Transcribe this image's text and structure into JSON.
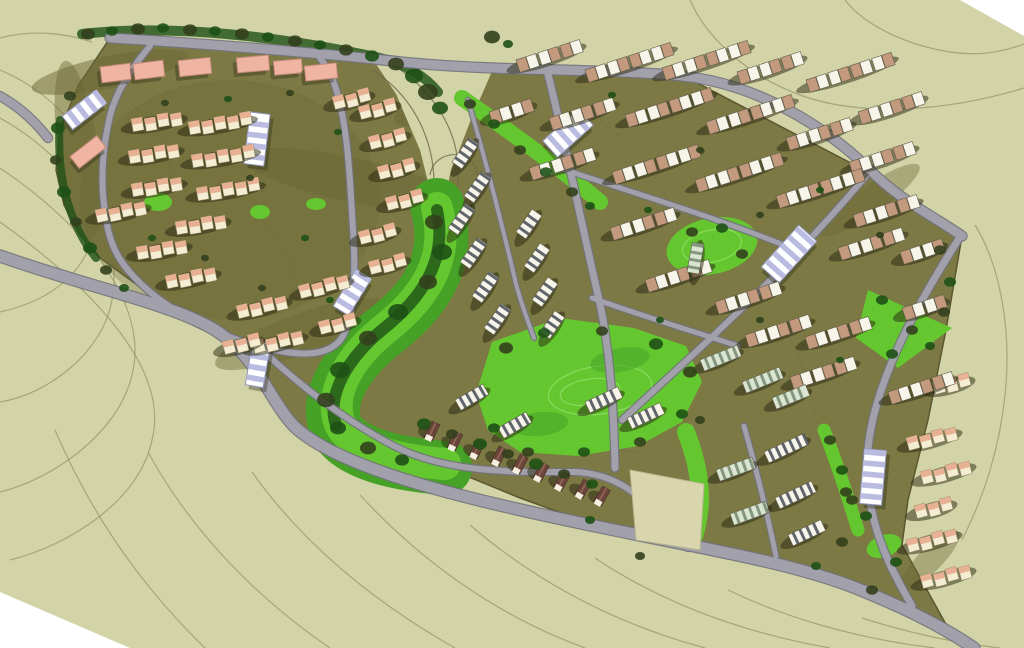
{
  "canvas": {
    "width": 1024,
    "height": 648
  },
  "palette": {
    "sage": "#d2d3a6",
    "paper": "#ffffff",
    "contour": "#97966c",
    "contour_dark": "#6b6a48",
    "site_olive": "#7c7944",
    "site_edge": "#5a5732",
    "hill_olive": "#6b6836",
    "road_fill": "#a1a0ab",
    "road_edge": "#72717c",
    "green_bright": "#64c72f",
    "green_mid": "#46a226",
    "green_dark": "#1f5c16",
    "green_ring": "#8fdd66",
    "tree_a": "#33401d",
    "tree_b": "#1e5116",
    "cream": "#f4edd3",
    "cabin_roof": "#e8b193",
    "cabin_edge": "#8a8560",
    "salmon_block": "#efb4a2",
    "salmon_edge": "#c28a79",
    "tan_roof": "#c49a7e",
    "white_roof": "#f7f4ea",
    "unit_edge": "#5f5c48",
    "stripe_dark": "#474c57",
    "mint_base": "#dbe6d2",
    "mint_stripe": "#74876e",
    "lav_stripe": "#b9bce0",
    "lav_edge": "#9096bb",
    "cottage_roof": "#6b453a",
    "cottage_ridge": "#93685a",
    "gable": "#f5f0e0",
    "parcel": "#d9d6ae",
    "parcel_edge": "#b9b690",
    "shadow": "rgba(40,40,16,0.5)",
    "shadow_soft": "rgba(40,40,16,0.35)"
  },
  "terrain": {
    "corners": [
      "0,592 130,648 0,648",
      "960,0 1024,0 1024,36"
    ]
  },
  "contours": [
    "M0,70 C60,95 105,150 98,215 C92,268 55,300 0,312",
    "M0,118 C75,160 125,235 112,300 C102,355 45,395 0,402",
    "M0,168 C85,225 150,305 132,375 C118,435 50,480 0,492",
    "M0,222 C95,290 170,370 152,440 C140,500 70,545 10,560",
    "M55,430 C85,500 130,575 205,648",
    "M148,452 C185,520 245,590 330,648",
    "M252,472 C300,540 370,600 455,648",
    "M360,495 C420,560 495,615 585,648",
    "M470,525 C540,585 620,625 705,648",
    "M595,558 C665,605 745,633 830,648",
    "M728,590 C790,620 865,640 935,648",
    "M862,618 C905,632 955,643 1000,648",
    "M690,0 C705,35 745,75 800,95 C860,117 945,112 1024,88",
    "M845,0 C862,22 900,44 950,52 C975,56 1000,53 1024,44",
    "M975,225 C1000,265 1012,330 1005,395 C1000,445 985,495 962,540",
    "M0,38 C30,30 62,32 92,42"
  ],
  "site": {
    "outline": "110,38 400,60 680,74 868,172 962,236 946,330 928,420 908,500 902,545 948,628 905,608 856,588 790,562 688,548 600,527 520,498 396,447 340,444 294,426 266,396 254,346 200,322 158,300 100,258 80,235 64,205 56,170 60,130 78,86",
    "shading": [
      [
        230,
        200,
        150,
        120,
        0,
        0.3
      ],
      [
        110,
        72,
        80,
        16,
        -12,
        0.5
      ],
      [
        78,
        150,
        20,
        90,
        -8,
        0.45
      ],
      [
        352,
        180,
        22,
        115,
        -78,
        0.5
      ],
      [
        300,
        334,
        90,
        20,
        -20,
        0.45
      ],
      [
        430,
        102,
        40,
        16,
        -30,
        0.5
      ],
      [
        870,
        200,
        60,
        14,
        -35,
        0.4
      ],
      [
        930,
        560,
        40,
        12,
        -45,
        0.4
      ]
    ],
    "wedge": "368,52 496,62 470,122 450,174 440,230 420,150 396,94",
    "wedge_contours": [
      "M372,70 C402,88 425,120 432,160 C436,185 434,205 430,222",
      "M388,62 C420,80 448,112 456,150 C460,175 458,198 452,218",
      "M398,186 C418,205 448,210 468,196 C486,183 478,158 458,155 C444,153 432,162 430,175"
    ],
    "inner_contours": [
      "M120,95 C150,115 175,150 170,190",
      "M600,120 C640,150 670,190 680,235",
      "M760,300 C790,330 810,370 815,415",
      "M520,420 C560,440 600,450 640,452",
      "M250,210 C280,235 300,270 298,305"
    ]
  },
  "greens": [
    {
      "kind": "band",
      "d": "M437,205 C452,258 428,298 386,330 C348,360 324,396 336,428 C348,452 392,464 445,468",
      "w": 54,
      "c": "green_mid"
    },
    {
      "kind": "band",
      "d": "M437,208 C450,258 426,296 386,328 C350,356 328,394 340,424 C352,448 394,460 445,464",
      "w": 32,
      "c": "green_bright"
    },
    {
      "kind": "poly",
      "pts": "492,342 560,318 634,328 686,346 702,382 682,422 638,446 578,456 520,452 488,430 476,394",
      "c": "green_bright"
    },
    {
      "kind": "ring",
      "cx": 600,
      "cy": 390,
      "rx": 52,
      "ry": 24,
      "rot": -8
    },
    {
      "kind": "ring",
      "cx": 590,
      "cy": 392,
      "rx": 30,
      "ry": 13,
      "rot": -8
    },
    {
      "kind": "ellipse",
      "cx": 712,
      "cy": 246,
      "rx": 46,
      "ry": 28,
      "rot": -12,
      "c": "green_bright"
    },
    {
      "kind": "ring",
      "cx": 712,
      "cy": 246,
      "rx": 30,
      "ry": 16,
      "rot": -12
    },
    {
      "kind": "poly",
      "pts": "868,290 952,328 898,368 856,338",
      "c": "green_bright"
    },
    {
      "kind": "band",
      "d": "M462,98 C508,130 558,166 600,202",
      "w": 16,
      "c": "green_bright"
    },
    {
      "kind": "band",
      "d": "M686,432 C700,468 706,504 692,542",
      "w": 18,
      "c": "green_bright"
    },
    {
      "kind": "band",
      "d": "M824,430 C838,466 848,498 858,530",
      "w": 13,
      "c": "green_bright"
    },
    {
      "kind": "ellipse",
      "cx": 158,
      "cy": 202,
      "rx": 14,
      "ry": 9,
      "rot": 0,
      "c": "green_bright"
    },
    {
      "kind": "ellipse",
      "cx": 260,
      "cy": 212,
      "rx": 10,
      "ry": 7,
      "rot": 0,
      "c": "green_bright"
    },
    {
      "kind": "ellipse",
      "cx": 316,
      "cy": 204,
      "rx": 10,
      "ry": 6,
      "rot": 0,
      "c": "green_bright"
    },
    {
      "kind": "ellipse",
      "cx": 884,
      "cy": 546,
      "rx": 18,
      "ry": 11,
      "rot": -20,
      "c": "green_bright"
    },
    {
      "kind": "ellipse",
      "cx": 620,
      "cy": 360,
      "rx": 30,
      "ry": 12,
      "rot": -10,
      "c": "green_mid"
    },
    {
      "kind": "ellipse",
      "cx": 540,
      "cy": 424,
      "rx": 28,
      "ry": 12,
      "rot": -6,
      "c": "green_mid"
    }
  ],
  "tree_bands": [
    {
      "d": "M82,34 C170,24 280,36 380,58 C405,64 425,76 438,92",
      "w": 10
    },
    {
      "d": "M60,120 C56,170 66,220 96,258",
      "w": 8
    },
    {
      "d": "M437,210 C448,262 420,300 382,330 C348,358 326,395 336,425",
      "w": 12
    }
  ],
  "roads": [
    {
      "d": "M0,256 C80,284 160,302 200,322 C254,346 266,396 294,426 C340,470 470,500 600,527 C700,548 790,562 856,588 C905,608 940,625 974,648",
      "w": 11
    },
    {
      "d": "M110,38 C210,44 330,54 402,62 C500,72 600,68 682,76 C760,84 830,130 872,172 C900,200 936,218 962,236",
      "w": 9
    },
    {
      "d": "M0,96 C18,106 34,120 48,138",
      "w": 8
    },
    {
      "d": "M150,46 C130,70 116,92 110,116 C102,150 100,185 106,218 C110,250 124,270 150,292 C184,320 235,344 286,352 C318,357 336,350 344,334 C354,312 356,270 353,230 C350,180 348,132 338,96 C334,80 328,68 320,58",
      "w": 6
    },
    {
      "d": "M258,346 C300,386 344,420 396,447 C450,474 520,472 574,472 C614,473 646,496 664,528 L688,548",
      "w": 6
    },
    {
      "d": "M546,66 C566,146 582,226 600,304 C610,352 614,408 615,468",
      "w": 7
    },
    {
      "d": "M866,176 C812,240 752,300 698,350 C672,374 648,396 622,420",
      "w": 6
    },
    {
      "d": "M958,240 C924,294 896,344 880,394 C864,442 864,482 874,520 C882,552 896,578 912,606",
      "w": 7
    },
    {
      "d": "M560,168 C636,194 712,216 786,246",
      "w": 5
    },
    {
      "d": "M592,298 C648,318 696,332 738,346",
      "w": 5
    },
    {
      "d": "M468,100 C486,162 502,224 516,284 C522,306 528,322 534,338",
      "w": 4
    },
    {
      "d": "M744,426 C756,468 766,508 776,556",
      "w": 5
    }
  ],
  "parcel": {
    "pts": "630,470 704,484 700,550 636,540"
  },
  "buildings": {
    "salmon_blocks": [
      [
        116,
        73,
        30,
        16,
        -7
      ],
      [
        149,
        70,
        30,
        16,
        -7
      ],
      [
        195,
        67,
        32,
        16,
        -6
      ],
      [
        253,
        64,
        32,
        15,
        -5
      ],
      [
        288,
        67,
        28,
        14,
        -5
      ],
      [
        321,
        72,
        32,
        15,
        -6
      ],
      [
        88,
        152,
        34,
        15,
        -38
      ]
    ],
    "lavender": [
      [
        84,
        110,
        42,
        17,
        -38
      ],
      [
        257,
        139,
        52,
        20,
        -83
      ],
      [
        352,
        293,
        42,
        18,
        -58
      ],
      [
        568,
        133,
        48,
        22,
        -42
      ],
      [
        789,
        254,
        56,
        24,
        -48
      ],
      [
        873,
        477,
        55,
        22,
        -85
      ],
      [
        258,
        364,
        45,
        18,
        -80
      ]
    ],
    "cabin_clusters": [
      [
        131,
        119,
        4,
        -10
      ],
      [
        188,
        122,
        5,
        -10
      ],
      [
        128,
        151,
        4,
        -10
      ],
      [
        191,
        155,
        5,
        -10
      ],
      [
        131,
        184,
        4,
        -10
      ],
      [
        196,
        188,
        5,
        -10
      ],
      [
        95,
        210,
        4,
        -12
      ],
      [
        175,
        222,
        4,
        -10
      ],
      [
        136,
        247,
        4,
        -10
      ],
      [
        165,
        276,
        4,
        -12
      ],
      [
        236,
        306,
        4,
        -14
      ],
      [
        252,
        341,
        4,
        -14
      ],
      [
        332,
        97,
        3,
        -15
      ],
      [
        358,
        107,
        3,
        -15
      ],
      [
        368,
        137,
        3,
        -15
      ],
      [
        377,
        167,
        3,
        -15
      ],
      [
        385,
        198,
        3,
        -15
      ],
      [
        358,
        232,
        3,
        -15
      ],
      [
        368,
        262,
        3,
        -15
      ],
      [
        298,
        286,
        4,
        -15
      ],
      [
        318,
        322,
        3,
        -15
      ],
      [
        222,
        342,
        3,
        -15
      ]
    ],
    "duplex_rows": [
      [
        516,
        60,
        3,
        -18
      ],
      [
        585,
        70,
        4,
        -18
      ],
      [
        662,
        68,
        4,
        -18
      ],
      [
        737,
        72,
        3,
        -18
      ],
      [
        806,
        80,
        4,
        -18
      ],
      [
        858,
        112,
        3,
        -18
      ],
      [
        489,
        112,
        2,
        -18
      ],
      [
        549,
        118,
        3,
        -18
      ],
      [
        625,
        115,
        4,
        -18
      ],
      [
        706,
        122,
        4,
        -18
      ],
      [
        786,
        138,
        3,
        -18
      ],
      [
        849,
        162,
        3,
        -18
      ],
      [
        529,
        168,
        3,
        -18
      ],
      [
        612,
        172,
        4,
        -18
      ],
      [
        695,
        180,
        4,
        -18
      ],
      [
        776,
        196,
        4,
        -18
      ],
      [
        853,
        215,
        3,
        -18
      ],
      [
        610,
        228,
        3,
        -18
      ],
      [
        838,
        248,
        3,
        -18
      ],
      [
        900,
        252,
        2,
        -18
      ],
      [
        645,
        280,
        3,
        -18
      ],
      [
        715,
        302,
        3,
        -18
      ],
      [
        902,
        308,
        2,
        -18
      ],
      [
        745,
        335,
        3,
        -18
      ],
      [
        805,
        337,
        3,
        -18
      ],
      [
        790,
        377,
        3,
        -18
      ],
      [
        888,
        392,
        3,
        -18
      ]
    ],
    "se_cabin_rows": [
      [
        932,
        382,
        3,
        -15
      ],
      [
        906,
        438,
        4,
        -15
      ],
      [
        920,
        472,
        4,
        -15
      ],
      [
        914,
        506,
        3,
        -15
      ],
      [
        906,
        540,
        4,
        -15
      ],
      [
        920,
        576,
        4,
        -15
      ]
    ],
    "townhouse_bars": [
      [
        452,
        162,
        30,
        -55,
        "w"
      ],
      [
        464,
        196,
        30,
        -55,
        "w"
      ],
      [
        448,
        228,
        30,
        -55,
        "w"
      ],
      [
        460,
        262,
        30,
        -55,
        "w"
      ],
      [
        472,
        296,
        30,
        -55,
        "w"
      ],
      [
        484,
        328,
        30,
        -55,
        "w"
      ],
      [
        516,
        232,
        28,
        -55,
        "w"
      ],
      [
        524,
        266,
        28,
        -55,
        "w"
      ],
      [
        532,
        300,
        28,
        -55,
        "w"
      ],
      [
        540,
        332,
        26,
        -55,
        "w"
      ],
      [
        585,
        402,
        36,
        -25,
        "w"
      ],
      [
        627,
        418,
        36,
        -25,
        "w"
      ],
      [
        455,
        400,
        32,
        -30,
        "w"
      ],
      [
        498,
        428,
        32,
        -30,
        "w"
      ],
      [
        700,
        360,
        40,
        -22,
        "m"
      ],
      [
        742,
        382,
        40,
        -22,
        "m"
      ],
      [
        772,
        398,
        36,
        -22,
        "m"
      ],
      [
        687,
        272,
        30,
        -80,
        "m"
      ],
      [
        716,
        470,
        38,
        -20,
        "m"
      ],
      [
        730,
        514,
        38,
        -20,
        "m"
      ],
      [
        764,
        452,
        44,
        -25,
        "w"
      ],
      [
        775,
        498,
        40,
        -25,
        "w"
      ],
      [
        788,
        535,
        36,
        -25,
        "w"
      ]
    ],
    "cottage_arc": [
      [
        432,
        431,
        25
      ],
      [
        455,
        441,
        25
      ],
      [
        477,
        449,
        26
      ],
      [
        499,
        456,
        27
      ],
      [
        520,
        464,
        28
      ],
      [
        541,
        472,
        28
      ],
      [
        562,
        481,
        29
      ],
      [
        583,
        489,
        30
      ],
      [
        602,
        496,
        30
      ]
    ]
  },
  "trees": [
    [
      88,
      34,
      7
    ],
    [
      112,
      31,
      6
    ],
    [
      138,
      29,
      7
    ],
    [
      163,
      28,
      6
    ],
    [
      190,
      30,
      7
    ],
    [
      215,
      31,
      6
    ],
    [
      242,
      34,
      7
    ],
    [
      268,
      37,
      6
    ],
    [
      295,
      41,
      7
    ],
    [
      320,
      45,
      6
    ],
    [
      346,
      50,
      7
    ],
    [
      372,
      56,
      7
    ],
    [
      396,
      64,
      8
    ],
    [
      414,
      76,
      9
    ],
    [
      428,
      92,
      10
    ],
    [
      440,
      108,
      8
    ],
    [
      492,
      37,
      8
    ],
    [
      508,
      44,
      5
    ],
    [
      70,
      96,
      6
    ],
    [
      58,
      128,
      7
    ],
    [
      56,
      160,
      6
    ],
    [
      64,
      192,
      7
    ],
    [
      76,
      222,
      6
    ],
    [
      90,
      248,
      7
    ],
    [
      106,
      270,
      6
    ],
    [
      124,
      288,
      5
    ],
    [
      165,
      103,
      4
    ],
    [
      228,
      99,
      4
    ],
    [
      290,
      93,
      4
    ],
    [
      338,
      132,
      4
    ],
    [
      250,
      178,
      4
    ],
    [
      305,
      238,
      4
    ],
    [
      205,
      258,
      4
    ],
    [
      152,
      238,
      4
    ],
    [
      262,
      288,
      4
    ],
    [
      330,
      300,
      4
    ],
    [
      434,
      222,
      9
    ],
    [
      442,
      252,
      10
    ],
    [
      428,
      282,
      9
    ],
    [
      398,
      312,
      10
    ],
    [
      368,
      338,
      9
    ],
    [
      340,
      370,
      10
    ],
    [
      326,
      400,
      9
    ],
    [
      338,
      428,
      8
    ],
    [
      368,
      448,
      8
    ],
    [
      402,
      460,
      7
    ],
    [
      506,
      348,
      7
    ],
    [
      544,
      333,
      6
    ],
    [
      602,
      331,
      6
    ],
    [
      656,
      344,
      7
    ],
    [
      690,
      372,
      7
    ],
    [
      682,
      414,
      6
    ],
    [
      640,
      442,
      6
    ],
    [
      584,
      452,
      6
    ],
    [
      528,
      452,
      6
    ],
    [
      494,
      428,
      6
    ],
    [
      470,
      104,
      6
    ],
    [
      494,
      124,
      6
    ],
    [
      520,
      150,
      6
    ],
    [
      546,
      172,
      6
    ],
    [
      572,
      192,
      6
    ],
    [
      590,
      206,
      5
    ],
    [
      692,
      232,
      6
    ],
    [
      722,
      228,
      6
    ],
    [
      742,
      254,
      6
    ],
    [
      882,
      300,
      6
    ],
    [
      912,
      330,
      6
    ],
    [
      892,
      354,
      6
    ],
    [
      830,
      440,
      6
    ],
    [
      842,
      470,
      6
    ],
    [
      852,
      500,
      6
    ],
    [
      424,
      424,
      7
    ],
    [
      452,
      434,
      6
    ],
    [
      480,
      444,
      7
    ],
    [
      508,
      454,
      6
    ],
    [
      536,
      464,
      7
    ],
    [
      564,
      474,
      6
    ],
    [
      592,
      484,
      6
    ],
    [
      940,
      250,
      6
    ],
    [
      950,
      282,
      6
    ],
    [
      944,
      312,
      6
    ],
    [
      930,
      346,
      5
    ],
    [
      846,
      492,
      6
    ],
    [
      866,
      516,
      6
    ],
    [
      842,
      542,
      6
    ],
    [
      896,
      562,
      6
    ],
    [
      872,
      590,
      6
    ],
    [
      612,
      95,
      4
    ],
    [
      700,
      150,
      4
    ],
    [
      648,
      210,
      4
    ],
    [
      760,
      215,
      4
    ],
    [
      820,
      190,
      4
    ],
    [
      880,
      235,
      4
    ],
    [
      660,
      320,
      4
    ],
    [
      760,
      320,
      4
    ],
    [
      840,
      360,
      4
    ],
    [
      700,
      420,
      5
    ],
    [
      590,
      520,
      5
    ],
    [
      640,
      556,
      5
    ],
    [
      816,
      566,
      5
    ]
  ]
}
